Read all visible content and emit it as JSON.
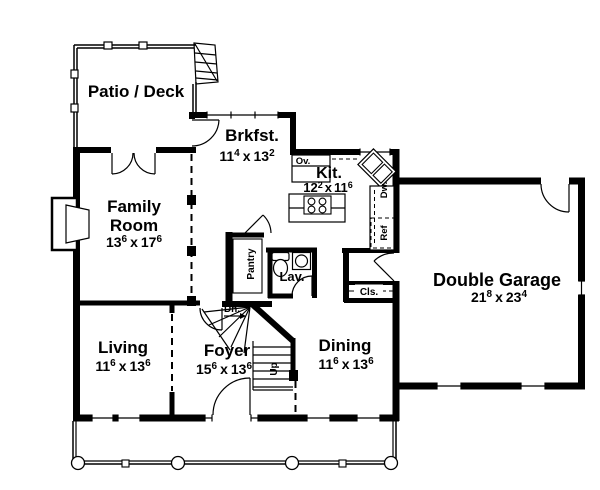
{
  "colors": {
    "line": "#000000",
    "background": "#ffffff"
  },
  "rooms": {
    "patio_deck": {
      "name": "Patio / Deck"
    },
    "brkfst": {
      "name": "Brkfst.",
      "dim": {
        "v1": "11",
        "s1": "4",
        "x": "x",
        "v2": "13",
        "s2": "2"
      }
    },
    "kit": {
      "name": "Kit.",
      "dim": {
        "v1": "12",
        "s1": "2",
        "x": "x",
        "v2": "11",
        "s2": "6"
      }
    },
    "family": {
      "name1": "Family",
      "name2": "Room",
      "dim": {
        "v1": "13",
        "s1": "6",
        "x": "x",
        "v2": "17",
        "s2": "6"
      }
    },
    "garage": {
      "name": "Double Garage",
      "dim": {
        "v1": "21",
        "s1": "8",
        "x": "x",
        "v2": "23",
        "s2": "4"
      }
    },
    "living": {
      "name": "Living",
      "dim": {
        "v1": "11",
        "s1": "6",
        "x": "x",
        "v2": "13",
        "s2": "6"
      }
    },
    "foyer": {
      "name": "Foyer",
      "dim": {
        "v1": "15",
        "s1": "6",
        "x": "x",
        "v2": "13",
        "s2": "6"
      }
    },
    "dining": {
      "name": "Dining",
      "dim": {
        "v1": "11",
        "s1": "6",
        "x": "x",
        "v2": "13",
        "s2": "6"
      }
    },
    "lav": {
      "name": "Lav."
    }
  },
  "labels": {
    "pantry": "Pantry",
    "closet": "Cls.",
    "oven": "Ov.",
    "dishwasher": "Dw.",
    "refrigerator": "Ref",
    "down": "Dn.",
    "up": "Up"
  }
}
